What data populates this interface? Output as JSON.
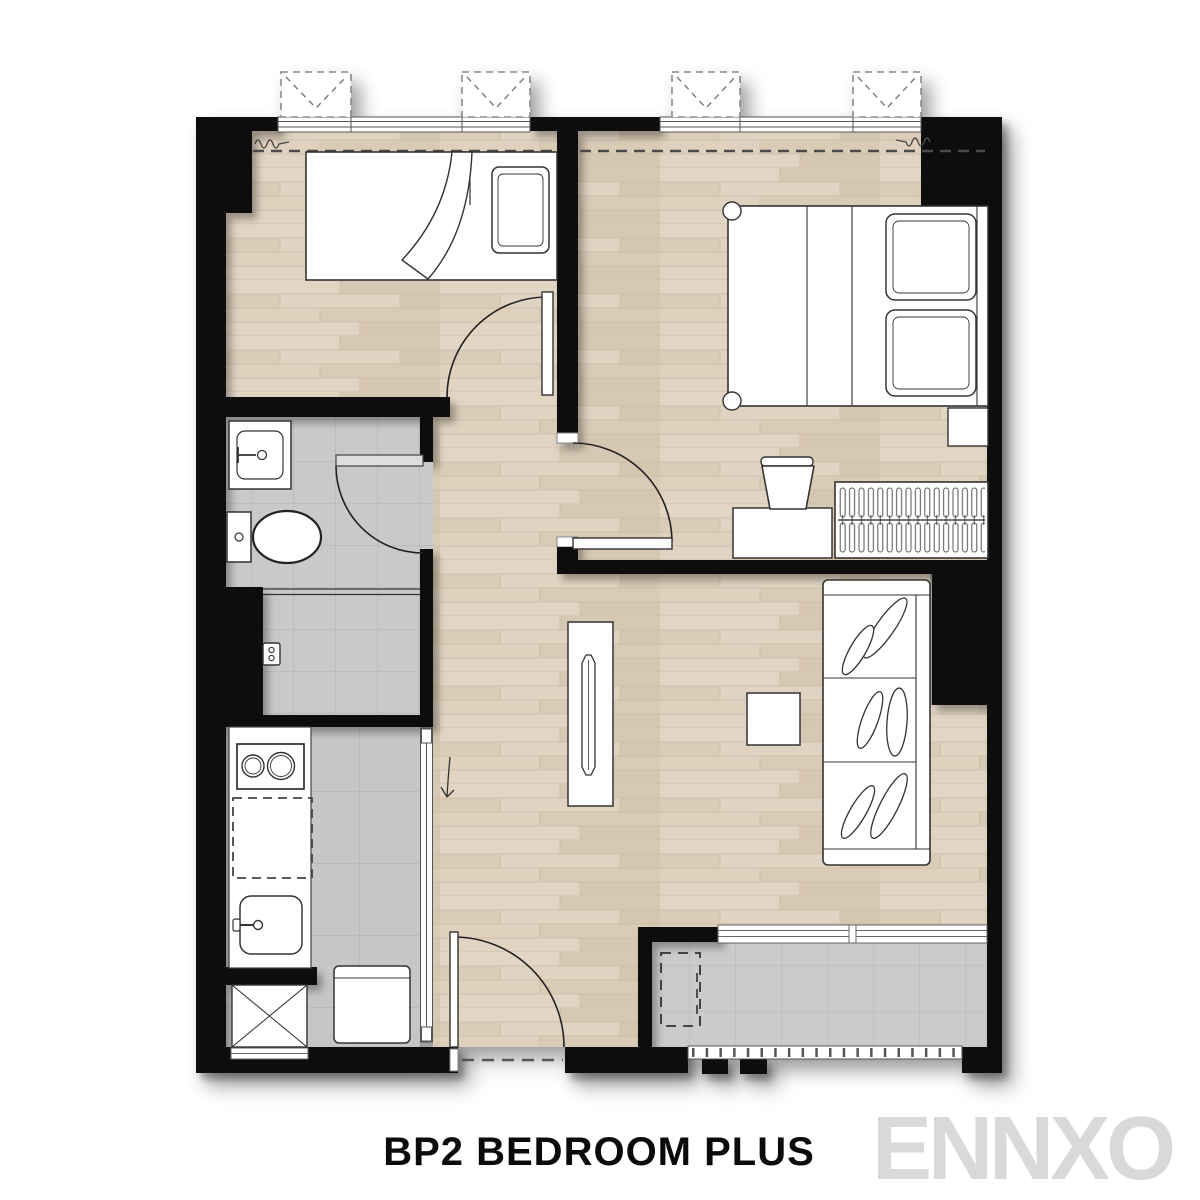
{
  "title": {
    "label": "BP2 BEDROOM PLUS"
  },
  "watermark": {
    "label": "ENNXO"
  },
  "colors": {
    "wall": "#0a0a0a",
    "wood_floor": "#ddcfbc",
    "tile_floor": "#c9c9c9",
    "furniture_fill": "#ffffff",
    "furniture_line": "#333333",
    "title_text": "#0b0b0b",
    "watermark_text": "#d9d9d9"
  },
  "plan_elements": [
    "awning-window-icon",
    "curtain-line",
    "single-bed-icon",
    "double-bed-icon",
    "pillow-icon",
    "wardrobe-hangers-icon",
    "desk-icon",
    "chair-icon",
    "nightstand-icon",
    "sofa-icon",
    "tv-console-icon",
    "coffee-table-icon",
    "vanity-sink-icon",
    "toilet-icon",
    "shower-mixer-icon",
    "cooktop-icon",
    "kitchen-sink-icon",
    "washing-machine-icon",
    "shaft-x-icon",
    "ac-unit-outline-icon",
    "balcony-railing-icon",
    "door-swing-icon",
    "sliding-door-icon",
    "entrance-door-icon"
  ]
}
